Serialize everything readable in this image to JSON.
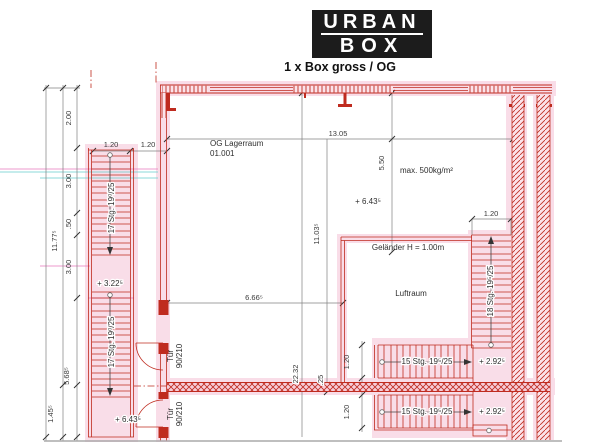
{
  "header": {
    "logo_top": "URBAN",
    "logo_bottom": "BOX",
    "subtitle": "1 x Box gross / OG"
  },
  "room": {
    "name": "OG Lagerraum",
    "number": "01.001",
    "load": "max. 500kg/m²",
    "railing": "Geländer H = 1.00m",
    "void": "Luftraum"
  },
  "stairs": {
    "left_upper": "17 Stg. 19⁰/25",
    "left_lower": "17 Stg. 19⁰/25",
    "right": "18 Stg. 19⁵/25",
    "bottom_upper": "15 Stg. 19⁵/25",
    "bottom_lower": "15 Stg. 19⁵/25"
  },
  "doors": {
    "label": "Tür",
    "size": "90/210"
  },
  "elevations": {
    "mid_landing": "+ 3.22⁵",
    "left_bottom": "+ 6.43⁵",
    "room_level": "+ 6.43⁵",
    "right_upper": "+ 2.92⁵",
    "right_lower": "+ 2.92⁵"
  },
  "dims": {
    "v1": "2.00",
    "v2": "3.00",
    "v3": ".50",
    "v4": "3.00",
    "v_total": "11.77⁵",
    "v5": "5.68⁵",
    "v6": "1.45⁵",
    "stair_w1": "1.20",
    "stair_w2": "1.20",
    "plan_w": "13.05",
    "room_h": "5.50",
    "v_mid": "11.03⁵",
    "v_span": "22.32",
    "wall_t": ".25",
    "part_w": "6.66⁵",
    "right_stair_w": "1.20",
    "bot_w1": "1.20",
    "bot_w2": "1.20"
  },
  "colors": {
    "wall_red": "#bf2b1f",
    "highlight_pink": "#f9dde8",
    "dim_gray": "#808080"
  }
}
